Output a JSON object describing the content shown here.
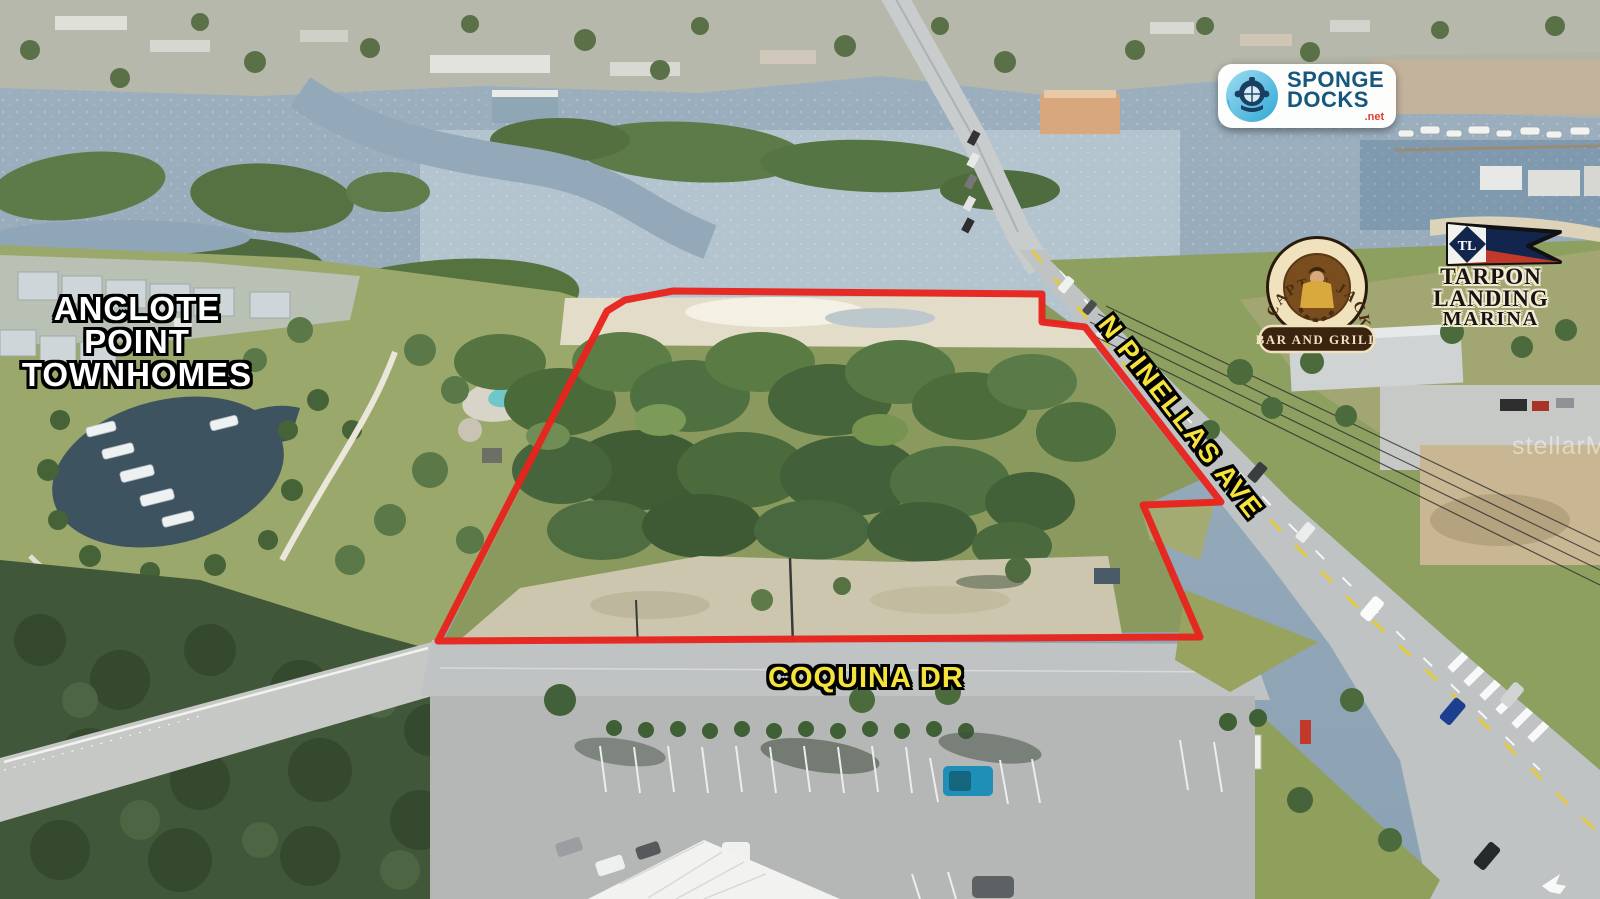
{
  "annotations": {
    "townhomes_label": {
      "line1": "ANCLOTE POINT",
      "line2": "TOWNHOMES"
    },
    "road_labels": {
      "n_pinellas": "N PINELLAS AVE",
      "coquina": "COQUINA DR"
    },
    "boundary_color": "#e8231d",
    "road_label_color": "#f5e33b"
  },
  "logos": {
    "sponge_docks": {
      "line1": "SPONGE",
      "line2": "DOCKS",
      "tld": ".net",
      "text_color": "#15577f",
      "tld_color": "#e23b2e"
    },
    "captn_jacks": {
      "name": "CAPT'N JACK'S",
      "tagline": "BAR AND GRILL"
    },
    "tarpon_landing": {
      "line1": "TARPON LANDING",
      "line2": "MARINA",
      "flag_monogram": "TL"
    }
  },
  "watermark": {
    "text": "stellarMLS"
  }
}
